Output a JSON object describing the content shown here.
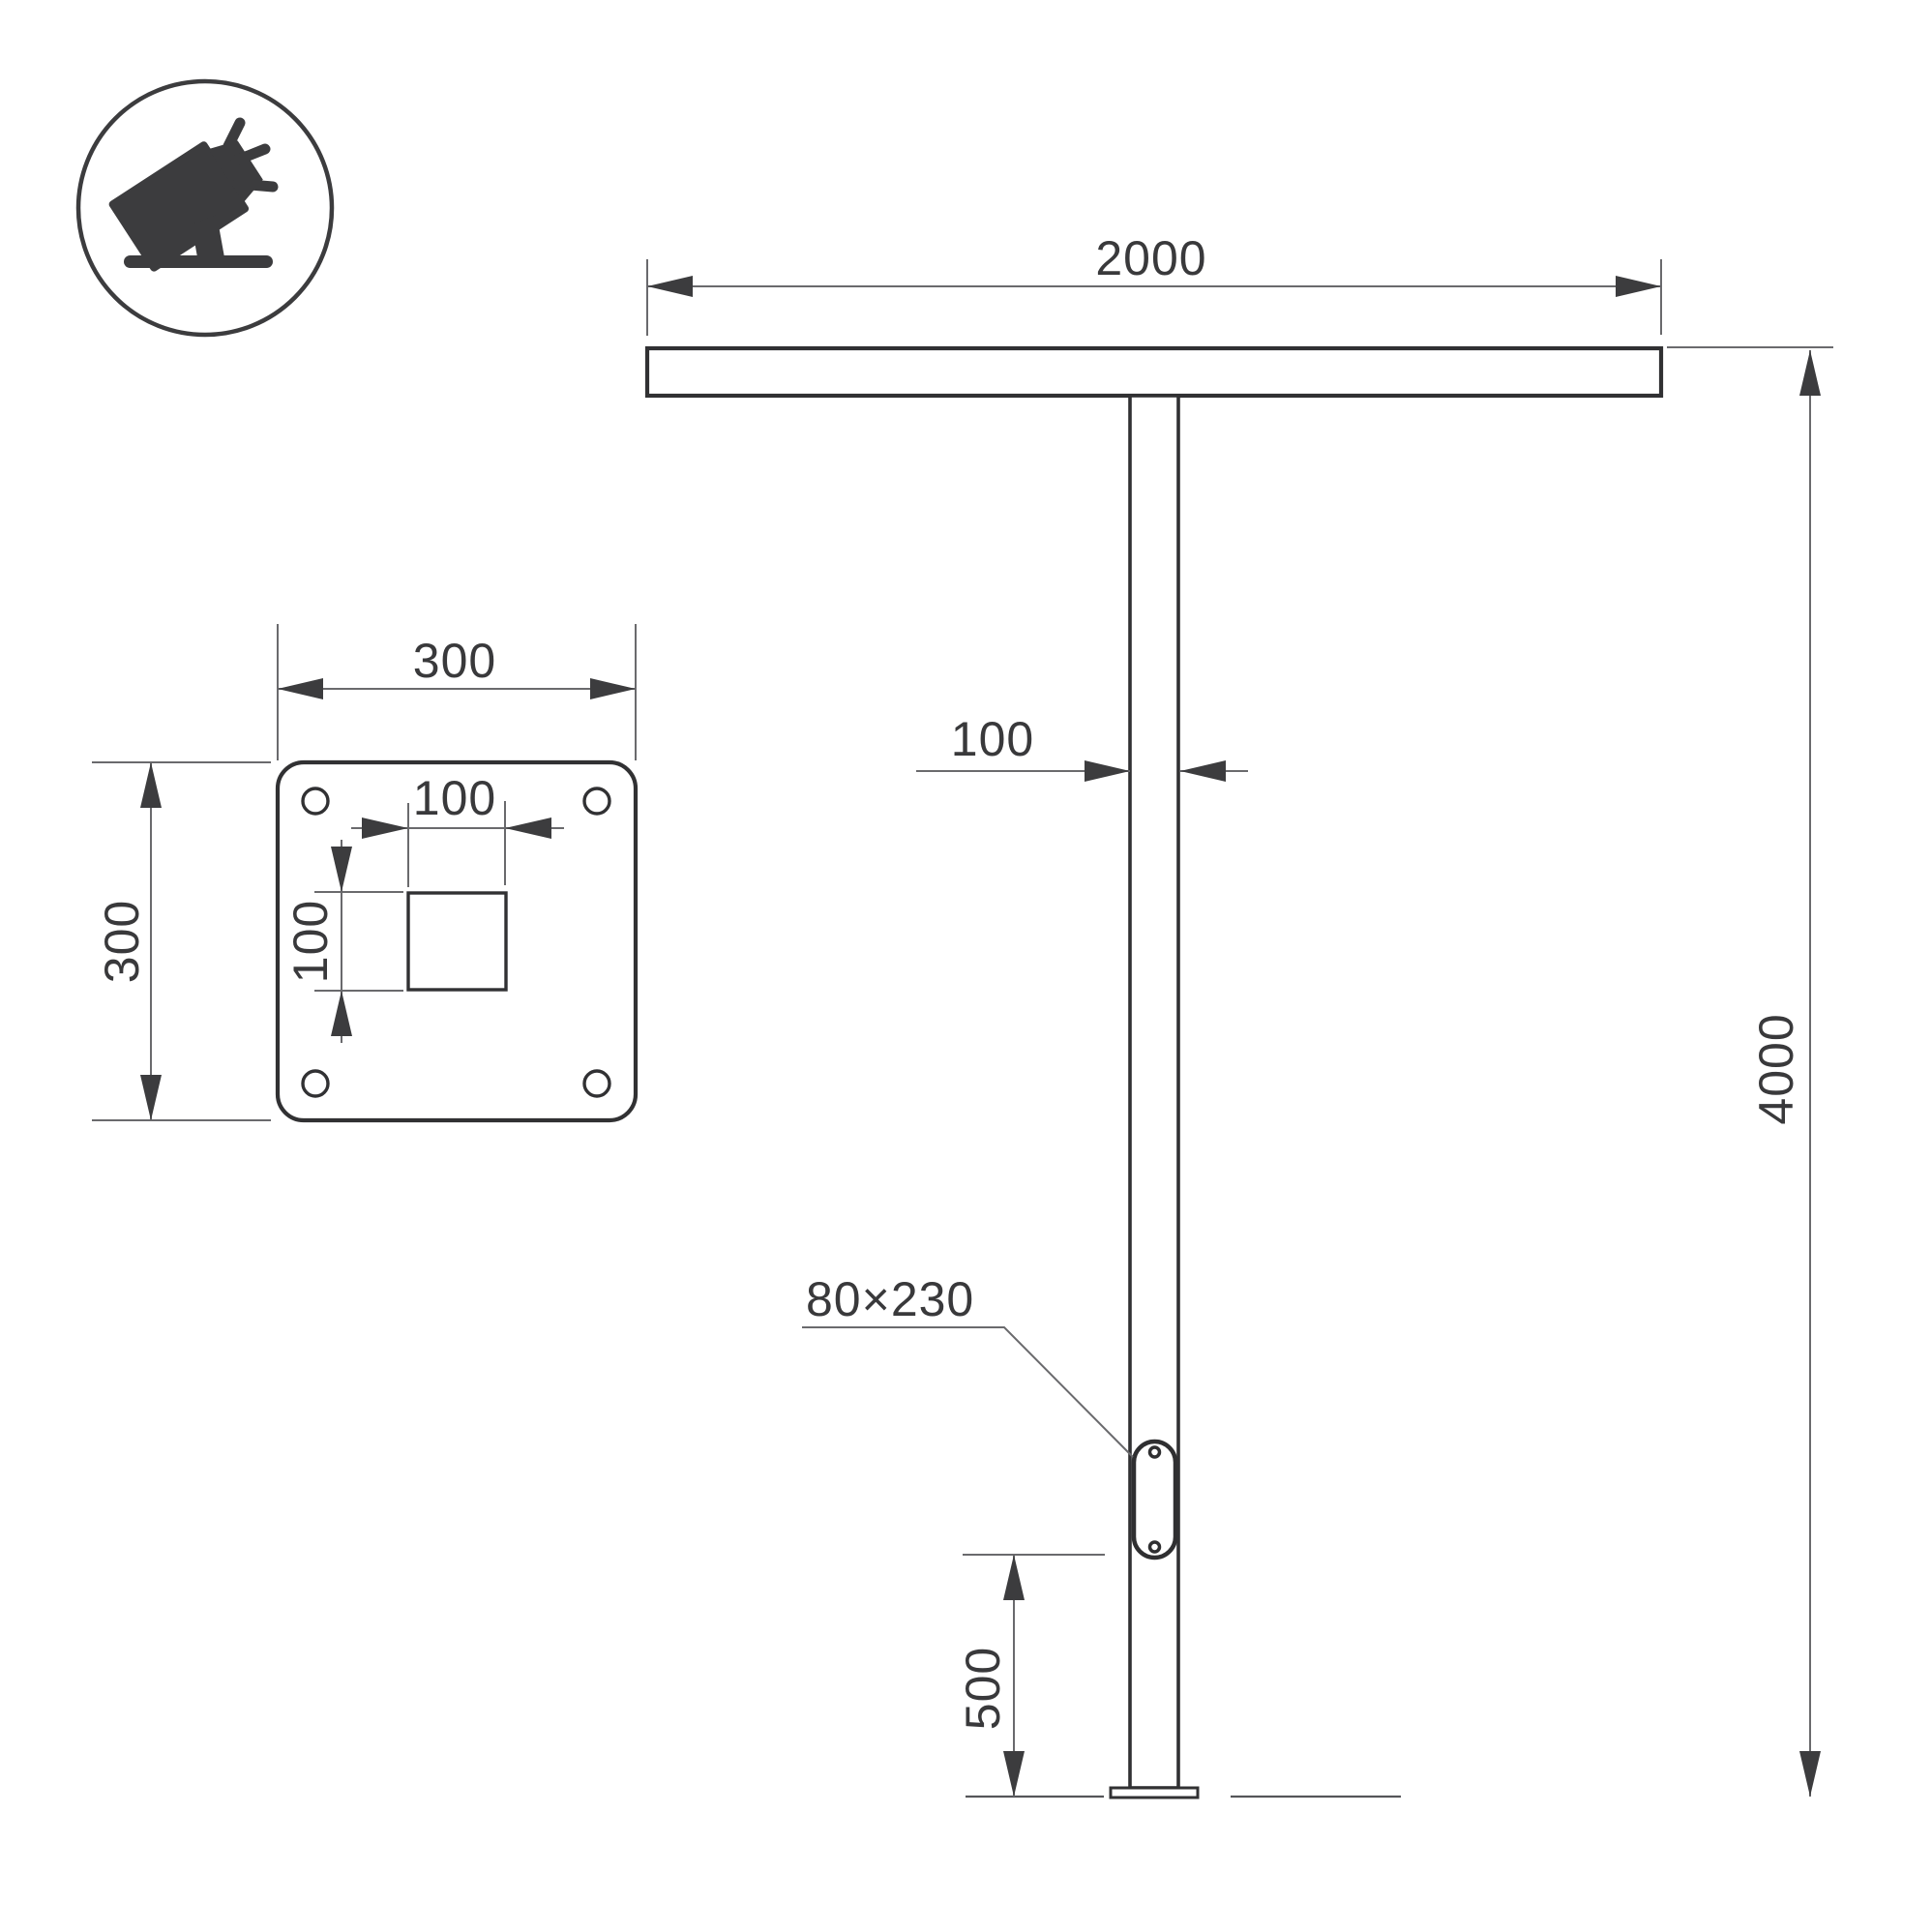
{
  "icon": {
    "name": "tilted-floodlight-on-ground-icon"
  },
  "colors": {
    "object_line": "#313133",
    "dimension_line": "#6a6a6d",
    "arrow": "#3c3c3e",
    "text": "#39393b",
    "background": "#ffffff"
  },
  "labels": {
    "crossbar_width": "2000",
    "pole_height": "4000",
    "pole_width": "100",
    "hatch_size": "80×230",
    "hatch_offset_from_ground": "500",
    "plate_width": "300",
    "plate_height": "300",
    "hole_width": "100",
    "hole_height": "100"
  }
}
